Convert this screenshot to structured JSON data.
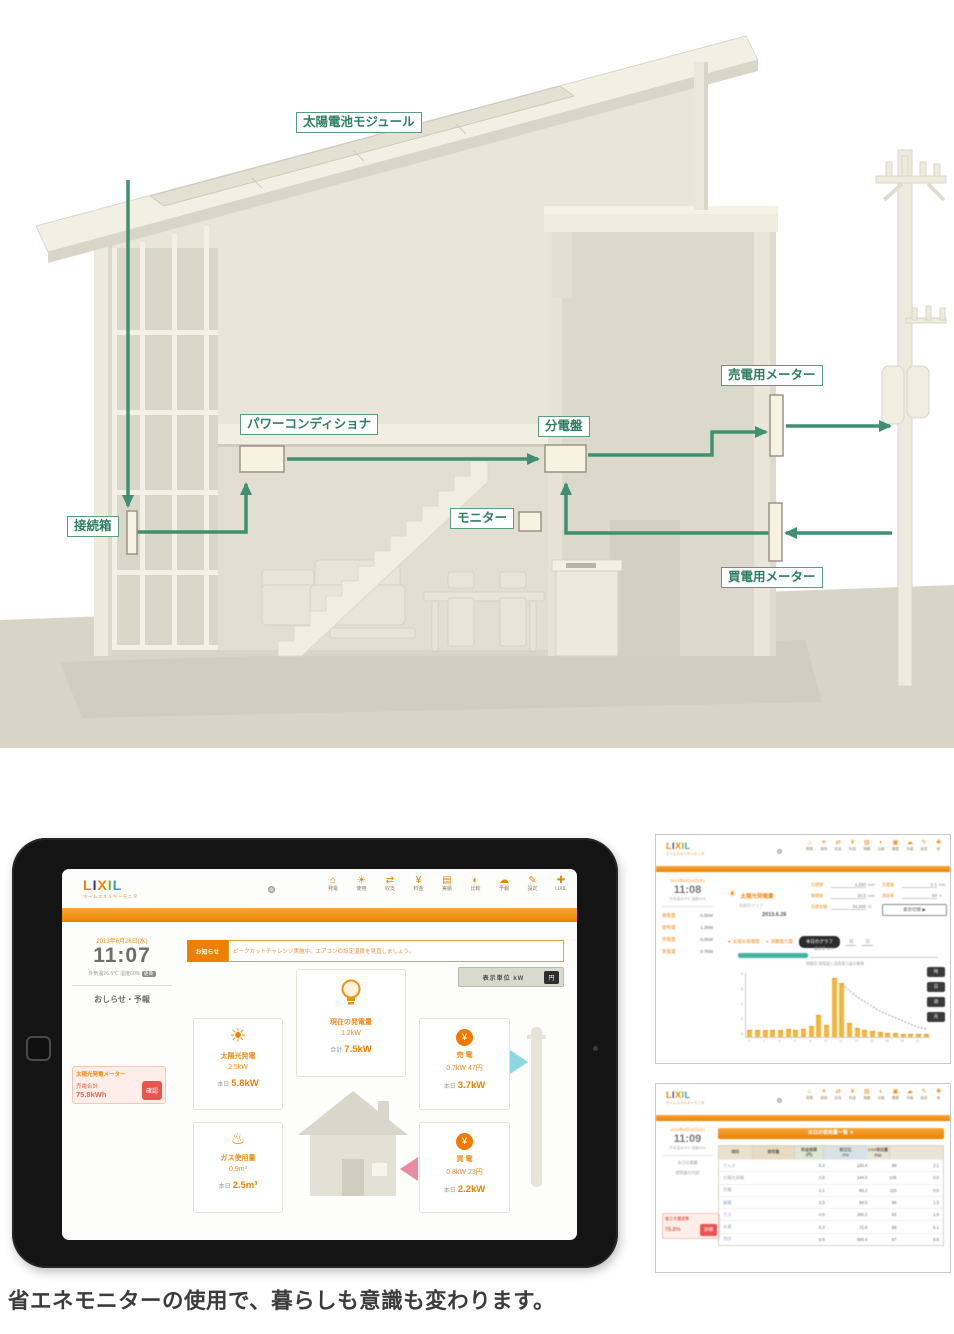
{
  "colors": {
    "accent_orange": "#ef8200",
    "diagram_green": "#3f8f70",
    "alert_red": "#e8554e",
    "gauge_teal": "#45b3a2"
  },
  "caption": "省エネモニターの使用で、暮らしも意識も変わります。",
  "diagram": {
    "labels": {
      "solar_module": "太陽電池モジュール",
      "junction_box": "接続箱",
      "power_conditioner": "パワーコンディショナ",
      "distribution_board": "分電盤",
      "monitor": "モニター",
      "sell_meter": "売電用メーター",
      "buy_meter": "買電用メーター"
    }
  },
  "tablet": {
    "logo": {
      "l1": "L",
      "l2": "I",
      "l3": "X",
      "l4": "I",
      "l5": "L"
    },
    "logo_tagline": "ホームエネルギーモニタ",
    "nav": [
      {
        "icon": "⌂",
        "label": "発電"
      },
      {
        "icon": "☀",
        "label": "使用"
      },
      {
        "icon": "⇄",
        "label": "収支"
      },
      {
        "icon": "¥",
        "label": "料金"
      },
      {
        "icon": "▤",
        "label": "実績"
      },
      {
        "icon": "◐",
        "label": "比較"
      },
      {
        "icon": "☁",
        "label": "予報"
      },
      {
        "icon": "✎",
        "label": "設定"
      },
      {
        "icon": "✚",
        "label": "LIXIL"
      }
    ],
    "sidebar": {
      "date": "2013年6月26日(水)",
      "time": "11:07",
      "weather": "外気温26.5℃ 湿度60%",
      "weather_badge": "更新",
      "notice": "おしらせ・予報",
      "meter": {
        "title": "太陽光発電メーター",
        "label": "売電合計",
        "value": "75.8kWh",
        "button": "確認"
      }
    },
    "banner": {
      "label": "お知らせ",
      "text": "ピークカットチャレンジ実施中。エアコンの設定温度を見直しましょう。"
    },
    "unit_toggle": {
      "label": "表示単位 kW",
      "button": "円"
    },
    "cards": {
      "center": {
        "label": "現在の発電量",
        "value": "1.2kW",
        "total_label": "合計",
        "total_value": "7.5kW"
      },
      "solar": {
        "label": "太陽光発電",
        "value": "2.5kW",
        "day_label": "本日",
        "day_value": "5.8kW"
      },
      "sell": {
        "label": "売 電",
        "value": "0.7kW 47円",
        "day_label": "本日",
        "day_value": "3.7kW"
      },
      "gas": {
        "label": "ガス使用量",
        "value": "0.9m³",
        "day_label": "本日",
        "day_value": "2.5m³"
      },
      "buy": {
        "label": "買 電",
        "value": "0.8kW 23円",
        "day_label": "本日",
        "day_value": "2.2kW"
      }
    }
  },
  "mini_nav": [
    {
      "icon": "⌂",
      "label": "発電"
    },
    {
      "icon": "☀",
      "label": "使用"
    },
    {
      "icon": "⇄",
      "label": "収支"
    },
    {
      "icon": "¥",
      "label": "料金"
    },
    {
      "icon": "▤",
      "label": "実績"
    },
    {
      "icon": "◐",
      "label": "比較"
    },
    {
      "icon": "▣",
      "label": "履歴"
    },
    {
      "icon": "☁",
      "label": "予報"
    },
    {
      "icon": "✎",
      "label": "設定"
    },
    {
      "icon": "✚",
      "label": "他"
    }
  ],
  "panel1": {
    "sidebar": {
      "date": "2013年6月26日(水)",
      "time": "11:08",
      "sub": "外気温26.5℃ 湿度60%",
      "stats": [
        {
          "label": "発電量",
          "value": "0.5kW"
        },
        {
          "label": "使用量",
          "value": "1.2kW"
        },
        {
          "label": "売電量",
          "value": "0.0kW"
        },
        {
          "label": "買電量",
          "value": "0.7kW"
        }
      ]
    },
    "report": {
      "title": "太陽光発電量",
      "sub": "時間別グラフ",
      "date": "2013.6.26"
    },
    "form": {
      "col1": [
        {
          "label": "目標値",
          "value": "1,250",
          "unit": "kWh"
        },
        {
          "label": "実績値",
          "value": "10.5",
          "unit": "kWh"
        },
        {
          "label": "目標金額",
          "value": "34,000",
          "unit": "円"
        }
      ],
      "col2": [
        {
          "label": "売電量",
          "value": "2.1",
          "unit": "kWh"
        },
        {
          "label": "達成率",
          "value": "84",
          "unit": "%"
        }
      ],
      "button": "表示切替 ▶"
    },
    "legend": [
      {
        "label": "太陽光発電量"
      },
      {
        "label": "消費電力量"
      }
    ],
    "graph_button": "本日のグラフ",
    "unit_month": "月",
    "unit_day": "日",
    "gauge_note": "達成率 84%",
    "chart_note": "時間別 発電量と消費電力量の推移",
    "range_pills": [
      "時",
      "日",
      "週",
      "月"
    ]
  },
  "panel2": {
    "sidebar": {
      "date": "2013年6月26日(水)",
      "time": "11:09",
      "sub": "外気温26.5℃ 湿度60%",
      "line1": "本日の実績",
      "line2": "使用量の内訳",
      "eco": {
        "title": "省エネ達成率",
        "value": "75.8%",
        "button": "詳細"
      }
    },
    "title": "本日の使用量一覧 ▼",
    "table": {
      "headers": [
        "項目",
        "使用量",
        "料金換算\n(円)",
        "前日比\n(%)",
        "CO2排出量\n(kg)"
      ],
      "rows": [
        [
          "でんき",
          "5.2",
          "130.4",
          "98",
          "2.1"
        ],
        [
          "太陽光発電",
          "3.8",
          "144.0",
          "105",
          "0.0"
        ],
        [
          "売電",
          "2.1",
          "88.2",
          "110",
          "0.0"
        ],
        [
          "買電",
          "3.5",
          "94.5",
          "96",
          "1.5"
        ],
        [
          "ガス",
          "0.9",
          "160.2",
          "92",
          "1.9"
        ],
        [
          "水道",
          "0.3",
          "72.6",
          "88",
          "0.1"
        ],
        [
          "合計",
          "9.9",
          "690.4",
          "97",
          "5.6"
        ]
      ]
    }
  },
  "chart_data": {
    "type": "bar",
    "title": "時間別 発電量と消費電力量の推移",
    "x": [
      0,
      1,
      2,
      3,
      4,
      5,
      6,
      7,
      8,
      9,
      10,
      11,
      12,
      13,
      14,
      15,
      16,
      17,
      18,
      19,
      20,
      21,
      22,
      23
    ],
    "xlabel": "時",
    "ylabel": "kWh",
    "ylim": [
      0,
      4
    ],
    "yticks": [
      0,
      1,
      2,
      3,
      4
    ],
    "grid": false,
    "legend_position": "top-right",
    "series": [
      {
        "name": "太陽光発電量",
        "type": "bar",
        "color": "#f3b53a",
        "values": [
          0.4,
          0.35,
          0.4,
          0.35,
          0.4,
          0.45,
          0.4,
          0.45,
          0.6,
          1.3,
          0.7,
          3.6,
          3.3,
          0.8,
          0.5,
          0.4,
          0.3,
          0.25,
          0.2,
          0.2,
          0.15,
          0.15,
          0.1,
          0.1
        ]
      },
      {
        "name": "消費電力量",
        "type": "line",
        "color": "#b0aeaa",
        "values": [
          null,
          null,
          null,
          null,
          null,
          null,
          null,
          null,
          null,
          null,
          null,
          null,
          3.3,
          2.9,
          2.5,
          2.2,
          1.9,
          1.6,
          1.4,
          1.2,
          1.0,
          0.8,
          0.6,
          0.5
        ]
      }
    ]
  }
}
